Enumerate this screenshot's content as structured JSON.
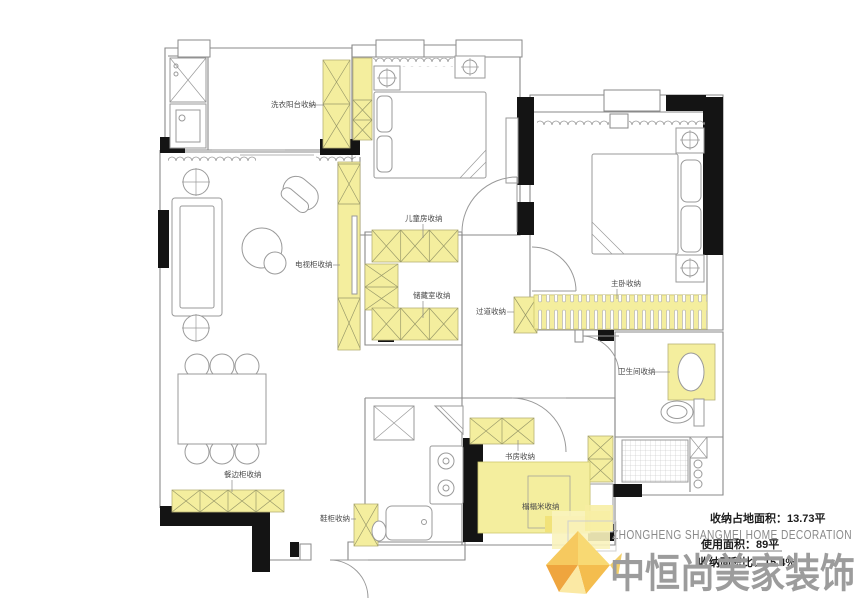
{
  "palette": {
    "storage_yellow": "#f4ee9e",
    "wall_black": "#141414",
    "line_gray": "#8a8a8a",
    "brand_gray": "#8a8a8a",
    "logo_gray": "#9c9c9c",
    "logo_orange": "#efa53e",
    "logo_amber": "#f4bd4e",
    "logo_light": "#f8d973"
  },
  "labels": {
    "laundry": "洗衣阳台收纳",
    "kids_room": "儿童房收纳",
    "tv_cabinet": "电视柜收纳",
    "storage_room": "储藏室收纳",
    "hallway": "过道收纳",
    "master_bedroom": "主卧收纳",
    "bathroom": "卫生间收纳",
    "study": "书房收纳",
    "tatami": "榻榻米收纳",
    "sideboard": "餐边柜收纳",
    "shoe_cabinet": "鞋柜收纳"
  },
  "stats": {
    "storage_area": "收纳占地面积：13.73平",
    "usable_area": "使用面积：89平",
    "storage_ratio": "收纳面积比：15.4%"
  },
  "brand": {
    "name_en": "ZHONGHENG SHANGMEI HOME DECORATION",
    "name_cn": "中恒尚美家装饰"
  }
}
